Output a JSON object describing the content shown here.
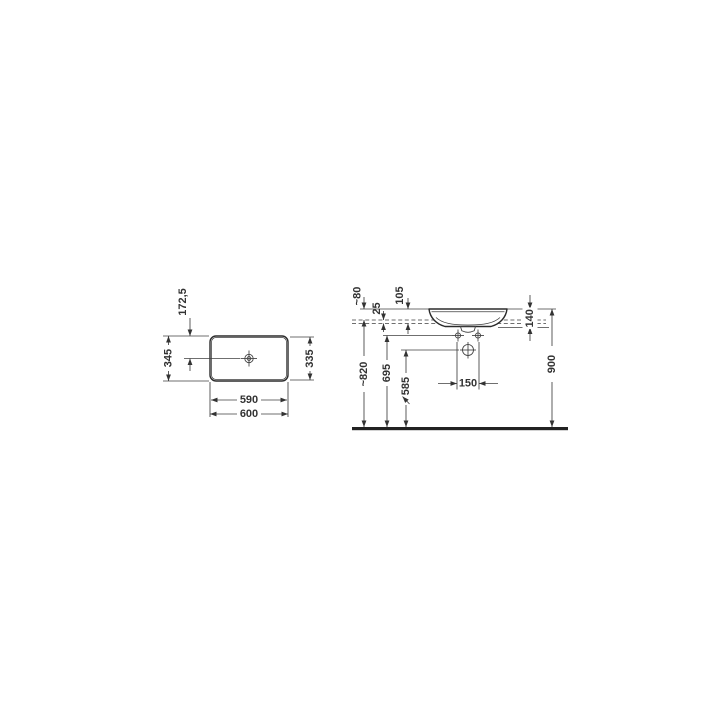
{
  "page": {
    "background": "#ffffff",
    "line_color": "#2b2b2b",
    "dim_line_color": "#3f3f3f",
    "text_color": "#333333"
  },
  "drawing": {
    "kind": "washbasin installation dimensional drawing",
    "units": "mm",
    "top_view": {
      "overall_width": "600",
      "inner_width": "590",
      "overall_depth": "345",
      "inner_depth": "335",
      "drain_center_offset": "172,5"
    },
    "side_view": {
      "rim_above_counter": "~80",
      "counter_thickness": "25",
      "rim_to_counter_underside": "105",
      "basin_height": "140",
      "rim_height_above_floor": "900",
      "counter_height_above_floor": "~820",
      "fixing_hole_height": "695",
      "drain_height": "585",
      "fixing_hole_spacing": "150"
    }
  }
}
